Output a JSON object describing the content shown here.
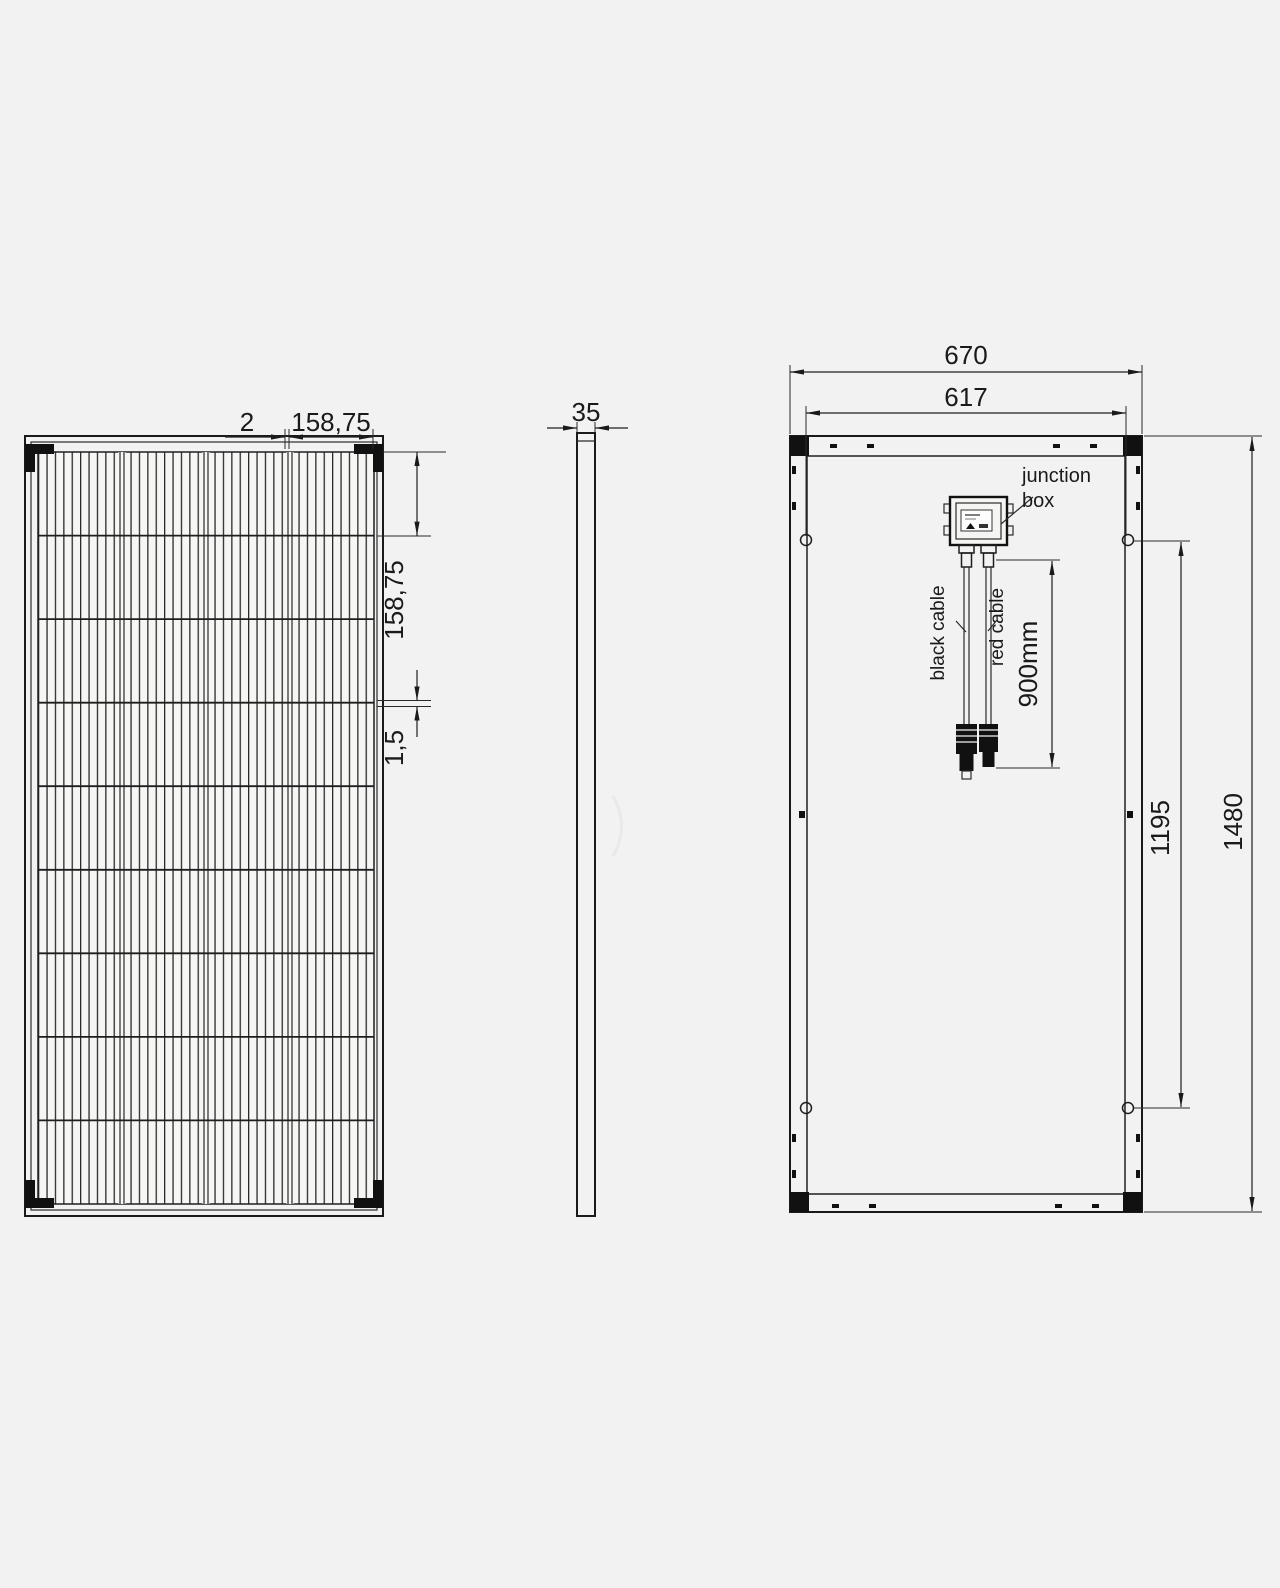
{
  "title": "Solar panel technical drawing - three views",
  "colors": {
    "background": "#f2f2f2",
    "line": "#1a1a1a"
  },
  "front_view": {
    "dim_cell_gap_top": "2",
    "dim_cell_width_top": "158,75",
    "dim_cell_height_right": "158,75",
    "dim_cell_gap_right": "1,5"
  },
  "side_view": {
    "dim_thickness": "35"
  },
  "rear_view": {
    "dim_outer_width": "670",
    "dim_mounting_width": "617",
    "dim_outer_height": "1480",
    "dim_mounting_height": "1195",
    "dim_cable_length": "900mm",
    "junction_box_label_line1": "junction",
    "junction_box_label_line2": "box",
    "black_cable_label": "black cable",
    "red_cable_label": "red cable"
  }
}
